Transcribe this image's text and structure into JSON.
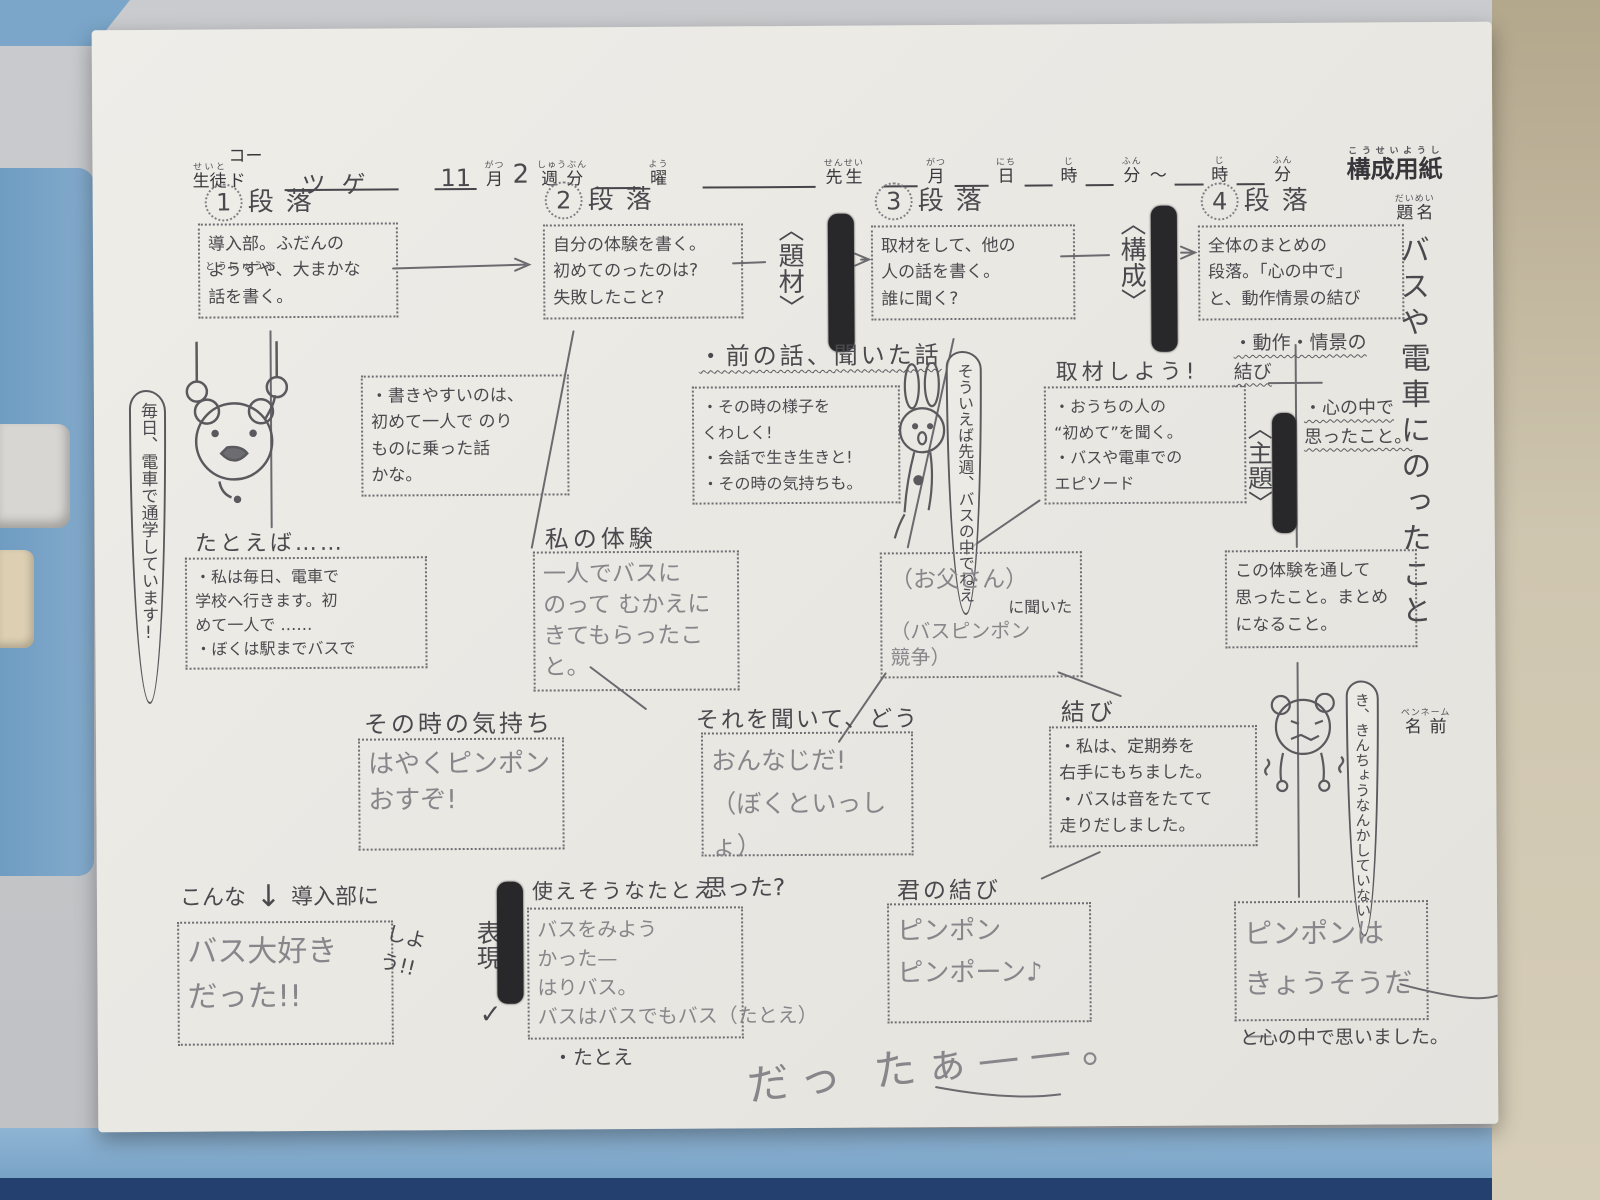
{
  "scene": {
    "board_color": "#7ba6c9",
    "board_dark_color": "#23406e",
    "paper_color": "#ece9e4",
    "marker_color": "#28282b"
  },
  "header": {
    "student_code": {
      "base": "生徒",
      "furigana": "せいと",
      "suffix": "コード",
      "value": "ツゲ"
    },
    "month_value": "11",
    "month": {
      "base": "月",
      "furigana": "がつ"
    },
    "week_value": "2",
    "week": {
      "base": "週分",
      "furigana": "しゅうぶん"
    },
    "day": {
      "base": "曜",
      "furigana": "よう"
    },
    "teacher": {
      "base": "先生",
      "furigana": "せんせい"
    },
    "month2": {
      "base": "月",
      "furigana": "がつ"
    },
    "date2": {
      "base": "日",
      "furigana": "にち"
    },
    "hour": {
      "base": "時",
      "furigana": "じ"
    },
    "minute": {
      "base": "分",
      "furigana": "ふん"
    },
    "tilde": "～",
    "hour2": {
      "base": "時",
      "furigana": "じ"
    },
    "minute2": {
      "base": "分",
      "furigana": "ふん"
    },
    "sheet_title": {
      "base": "構成用紙",
      "furigana": "こうせいようし"
    }
  },
  "paragraphs": [
    {
      "number": "1",
      "label": "段落",
      "furigana": "とうにゅうぶ",
      "text": "導入部。ふだんの\nようすや、大まかな\n話を書く。"
    },
    {
      "number": "2",
      "label": "段落",
      "text": "自分の体験を書く。\n初めてのったのは?\n失敗したこと?"
    },
    {
      "number": "3",
      "label": "段落",
      "text": "取材をして、他の\n人の話を書く。\n誰に聞く?"
    },
    {
      "number": "4",
      "label": "段落",
      "text": "全体のまとめの\n段落。「心の中で」\nと、動作情景の結び"
    }
  ],
  "connectors": {
    "daizai": "〈題材〉",
    "kousei": "〈構成〉",
    "shudai": "〈主題〉",
    "hyougen": "表現",
    "check": "✓"
  },
  "title_block": {
    "label": "題名",
    "furigana": "だいめい",
    "value": "バスや電車にのったこと"
  },
  "name_block": {
    "label": "名前",
    "furigana": "ペンネーム"
  },
  "drawings": {
    "frog": "frog-hanging-from-train-straps",
    "rabbit": "rabbit",
    "bear": "trembling-bear"
  },
  "notes": {
    "frog_bubble": "毎日、電車で通学しています!",
    "easy_to_write": "・書きやすいのは、\n初めて一人で のり\nものに乗った話\nかな。",
    "previous_story": "・前の話、聞いた話",
    "detail_lines": "・その時の様子を\nくわしく!\n・会話で生き生きと!\n・その時の気持ちも。",
    "rabbit_bubble": "そういえば先週、バスの中でねえ",
    "interview_heading": "取材しよう!",
    "interview_lines": "・おうちの人の\n“初めて”を聞く。\n・バスや電車での\nエピソード",
    "action_ending": "・動作・情景の\n結び",
    "heart_note": "・心の中で\n思ったこと。",
    "example_heading": "たとえば……",
    "example_lines": "・私は毎日、電車で\n学校へ行きます。初\nめて一人で ……\n・ぼくは駅までバスで",
    "my_experience_heading": "私の体験",
    "my_experience_lines": "一人でバスに\nのって むかえに\nきてもらったこと。",
    "heard_line1": "（お父さん）",
    "heard_line2": "に聞いた",
    "heard_line3": "（バスピンポン\n競争）",
    "through_lines": "この体験を通して\n思ったこと。まとめ\nになること。",
    "feeling_heading": "その時の気持ち",
    "feeling_lines": "はやくピンポン\nおすぞ!",
    "how_heading": "それを聞いて、どう",
    "how_lines": "おんなじだ!\n（ぼくといっしょ）",
    "how_footer": "思った?",
    "musubi_heading": "結び",
    "musubi_lines": "・私は、定期券を\n右手にもちました。\n・バスは音をたてて\n走りだしました。",
    "bear_bubble": "き、きんちょうなんかしていない",
    "intro_prefix": "こんな",
    "intro_arrow": "↓",
    "intro_suffix": "導入部に",
    "intro_shiyou": "しよう!!",
    "intro_lines": "バス大好き\nだった!!",
    "simile_heading": "使えそうなたとえ",
    "simile_lines": "バスをみよう\nかった—\nはりバス。\nバスはバスでもバス（たとえ）",
    "simile_footer": "・たとえ",
    "your_musubi_heading": "君の結び",
    "your_musubi_lines": "ピンポン\nピンポーン♪",
    "pinpon_lines": "ピンポンは\nきょうそうだ—",
    "pinpon_footer": "と心の中で思いました。",
    "scrawl": "だっ たぁ——。"
  }
}
